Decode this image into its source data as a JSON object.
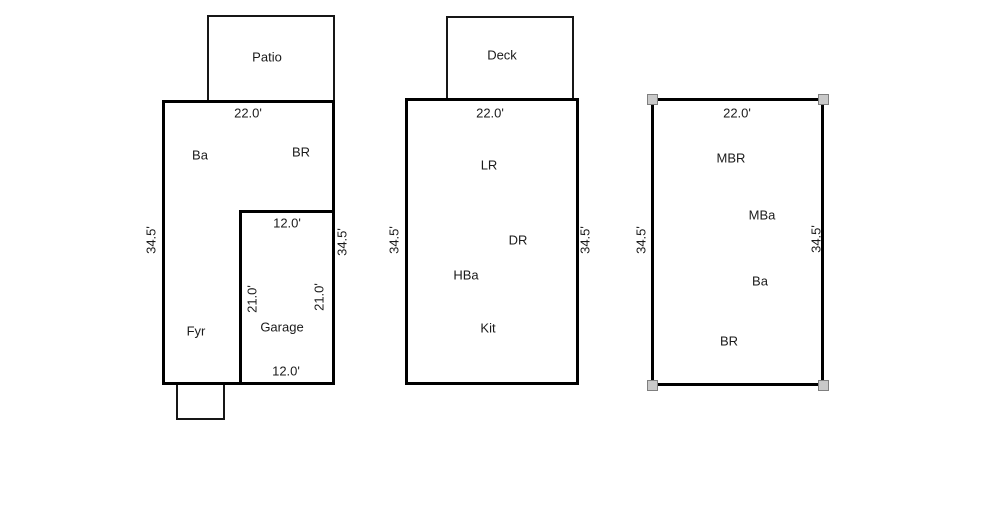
{
  "plans": {
    "left": {
      "patio_label": "Patio",
      "width_dim": "22.0'",
      "room_ba": "Ba",
      "room_br": "BR",
      "garage_width_top": "12.0'",
      "height_dim_left": "34.5'",
      "height_dim_right": "34.5'",
      "garage_height_left": "21.0'",
      "garage_height_right": "21.0'",
      "garage_label": "Garage",
      "room_fyr": "Fyr",
      "garage_width_bottom": "12.0'"
    },
    "middle": {
      "deck_label": "Deck",
      "width_dim": "22.0'",
      "room_lr": "LR",
      "room_dr": "DR",
      "height_dim_left": "34.5'",
      "height_dim_right": "34.5'",
      "room_hba": "HBa",
      "room_kit": "Kit"
    },
    "right": {
      "width_dim": "22.0'",
      "room_mbr": "MBR",
      "room_mba": "MBa",
      "height_dim_left": "34.5'",
      "height_dim_right": "34.5'",
      "room_ba": "Ba",
      "room_br": "BR"
    }
  },
  "colors": {
    "background": "#ffffff",
    "outline": "#000000",
    "selection_handle_fill": "#c9c9c9",
    "selection_handle_border": "#7f7f7f"
  }
}
